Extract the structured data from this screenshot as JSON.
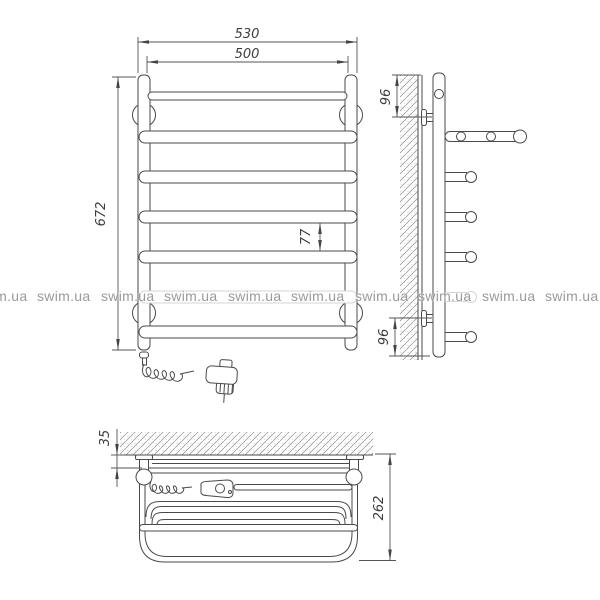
{
  "watermark": {
    "text": "swim.ua"
  },
  "dimensions": {
    "front_view": {
      "overall_width": "530",
      "rail_width": "500",
      "height": "672",
      "rung_spacing": "77"
    },
    "side_view": {
      "top_bracket_offset": "96",
      "bottom_bracket_offset": "96"
    },
    "top_view": {
      "wall_clearance": "35",
      "depth": "262"
    }
  },
  "colors": {
    "line": "#4a4a4a",
    "dimension_text": "#3d3d3d",
    "watermark_text": "#9a9a9a",
    "faded_line": "#d4d4d4"
  }
}
